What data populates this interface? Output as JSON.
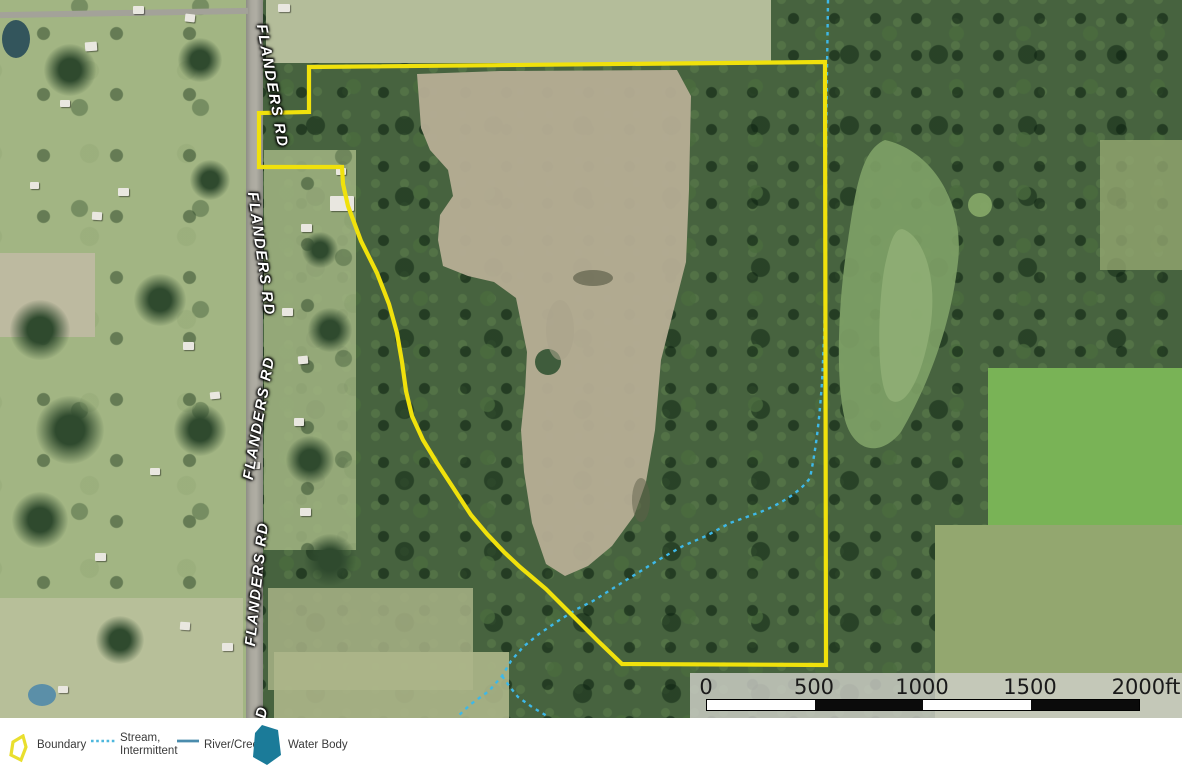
{
  "map": {
    "road_labels": [
      {
        "text": "FLANDERS RD"
      },
      {
        "text": "FLANDERS RD"
      },
      {
        "text": "FLANDERS RD"
      },
      {
        "text": "FLANDERS RD"
      },
      {
        "text": "D"
      }
    ],
    "features": {
      "boundary_color": "#f0e10c",
      "stream_color": "#3eb8e8",
      "river_color": "#4a8cad",
      "water_body_color": "#1b7b99"
    }
  },
  "scalebar": {
    "ticks": [
      "0",
      "500",
      "1000",
      "1500"
    ],
    "end_label": "2000ft"
  },
  "legend": {
    "items": [
      {
        "name": "boundary",
        "icon": "boundary-outline-icon",
        "label": "Boundary"
      },
      {
        "name": "stream-intermittent",
        "icon": "dashed-line-icon",
        "label_line1": "Stream,",
        "label_line2": "Intermittent"
      },
      {
        "name": "river-creek",
        "icon": "solid-line-icon",
        "label": "River/Creek"
      },
      {
        "name": "water-body",
        "icon": "water-polygon-icon",
        "label": "Water Body"
      }
    ]
  }
}
